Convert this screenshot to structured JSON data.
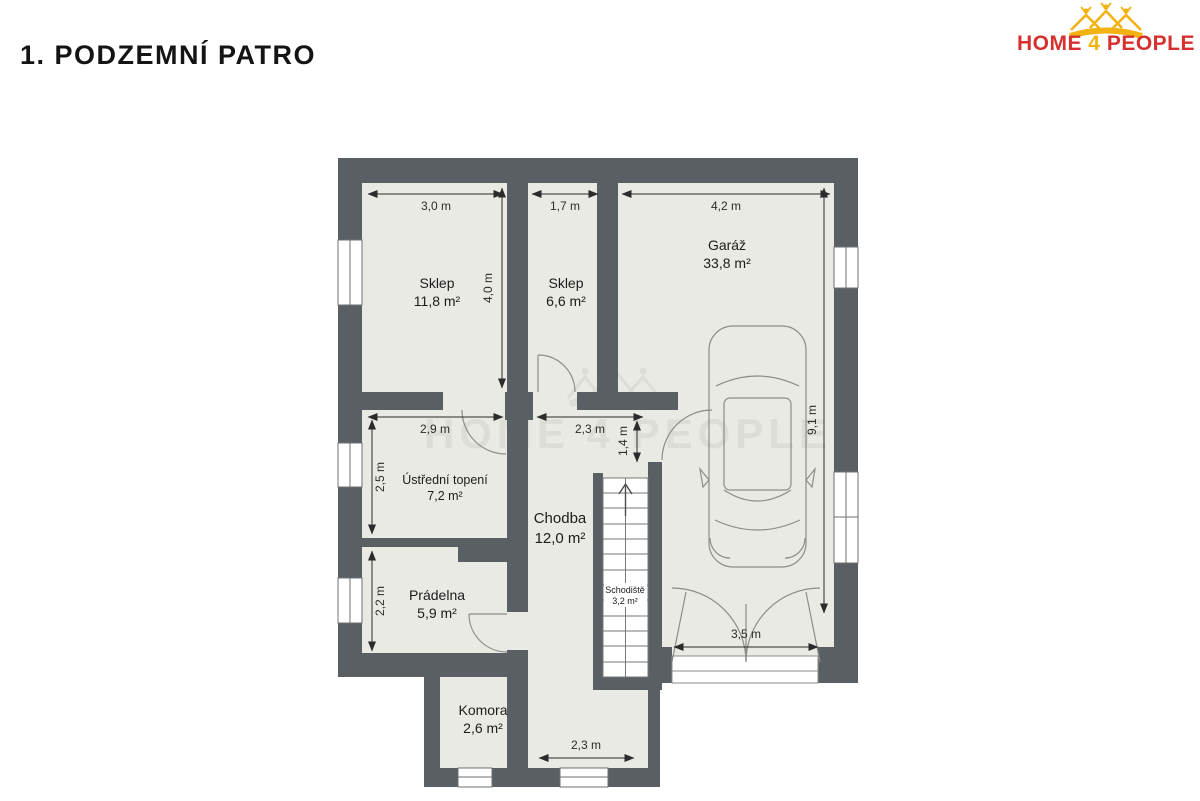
{
  "title": "1. PODZEMNÍ PATRO",
  "logo": {
    "home": "HOME",
    "four": "4",
    "people": "PEOPLE",
    "icon": "crown-of-houses-and-people",
    "red": "#d5322f",
    "yellow": "#f2b212"
  },
  "watermark_text": "HOME 4 PEOPLE",
  "colors": {
    "wall": "#5a5f63",
    "room_fill": "#e9eae3",
    "thin_line": "#8b8e89",
    "dimension": "#2b2b2b",
    "background": "#ffffff"
  },
  "rooms": [
    {
      "name": "Sklep",
      "area": "11,8 m²"
    },
    {
      "name": "Sklep",
      "area": "6,6 m²"
    },
    {
      "name": "Garáž",
      "area": "33,8 m²"
    },
    {
      "name": "Ústřední topení",
      "area": "7,2 m²"
    },
    {
      "name": "Chodba",
      "area": "12,0 m²"
    },
    {
      "name": "Prádelna",
      "area": "5,9 m²"
    },
    {
      "name": "Schodiště",
      "area": "3,2 m²"
    },
    {
      "name": "Komora",
      "area": "2,6 m²"
    }
  ],
  "dims": [
    {
      "label": "3,0 m"
    },
    {
      "label": "1,7 m"
    },
    {
      "label": "4,2 m"
    },
    {
      "label": "4,0 m"
    },
    {
      "label": "9,1 m"
    },
    {
      "label": "2,9 m"
    },
    {
      "label": "2,5 m"
    },
    {
      "label": "2,3 m"
    },
    {
      "label": "1,4 m"
    },
    {
      "label": "2,2 m"
    },
    {
      "label": "3,5 m"
    },
    {
      "label": "2,3 m"
    }
  ]
}
